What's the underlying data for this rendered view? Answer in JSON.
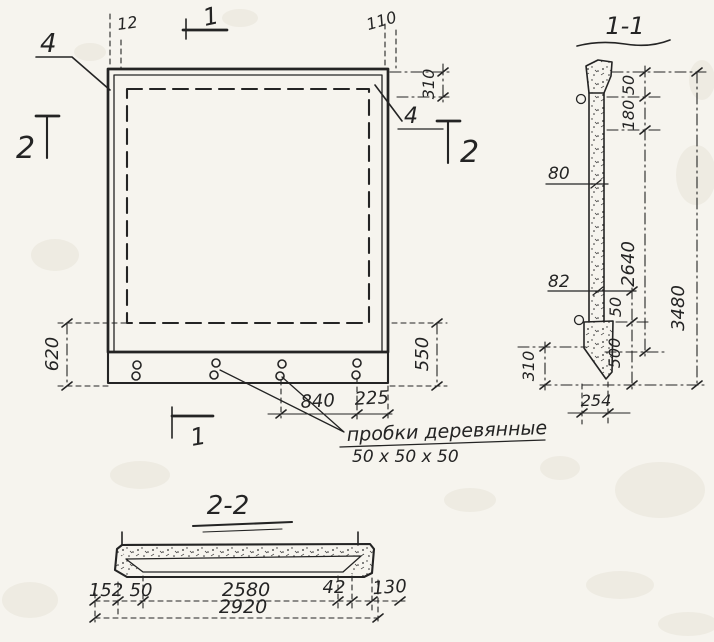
{
  "colors": {
    "ink": "#242424",
    "paper": "#f6f4ee"
  },
  "front_view": {
    "section_marks": {
      "one_top": "1",
      "one_bottom": "1",
      "two_left": "2",
      "two_right": "2"
    },
    "callouts": {
      "top_left": "4",
      "top_right": "4"
    },
    "dims": {
      "top_left_gap": "12",
      "top_right_gap": "110",
      "right_top": "310",
      "left_height": "620",
      "right_height": "550",
      "plug_spacing": "840",
      "plug_edge": "225"
    },
    "note": {
      "line1": "пробки деревянные",
      "line2": "50 х 50 х 50"
    }
  },
  "section_1_1": {
    "title": "1-1",
    "dims": {
      "top_50": "50",
      "top_180": "180",
      "web_80": "80",
      "web_82": "82",
      "height_2640": "2640",
      "height_total_3480": "3480",
      "bottom_50": "50",
      "bottom_500": "500",
      "bottom_310": "310",
      "base_width": "254"
    }
  },
  "section_2_2": {
    "title": "2-2",
    "chain": [
      "152",
      "50",
      "2580",
      "42",
      "130"
    ],
    "total": "2920"
  }
}
